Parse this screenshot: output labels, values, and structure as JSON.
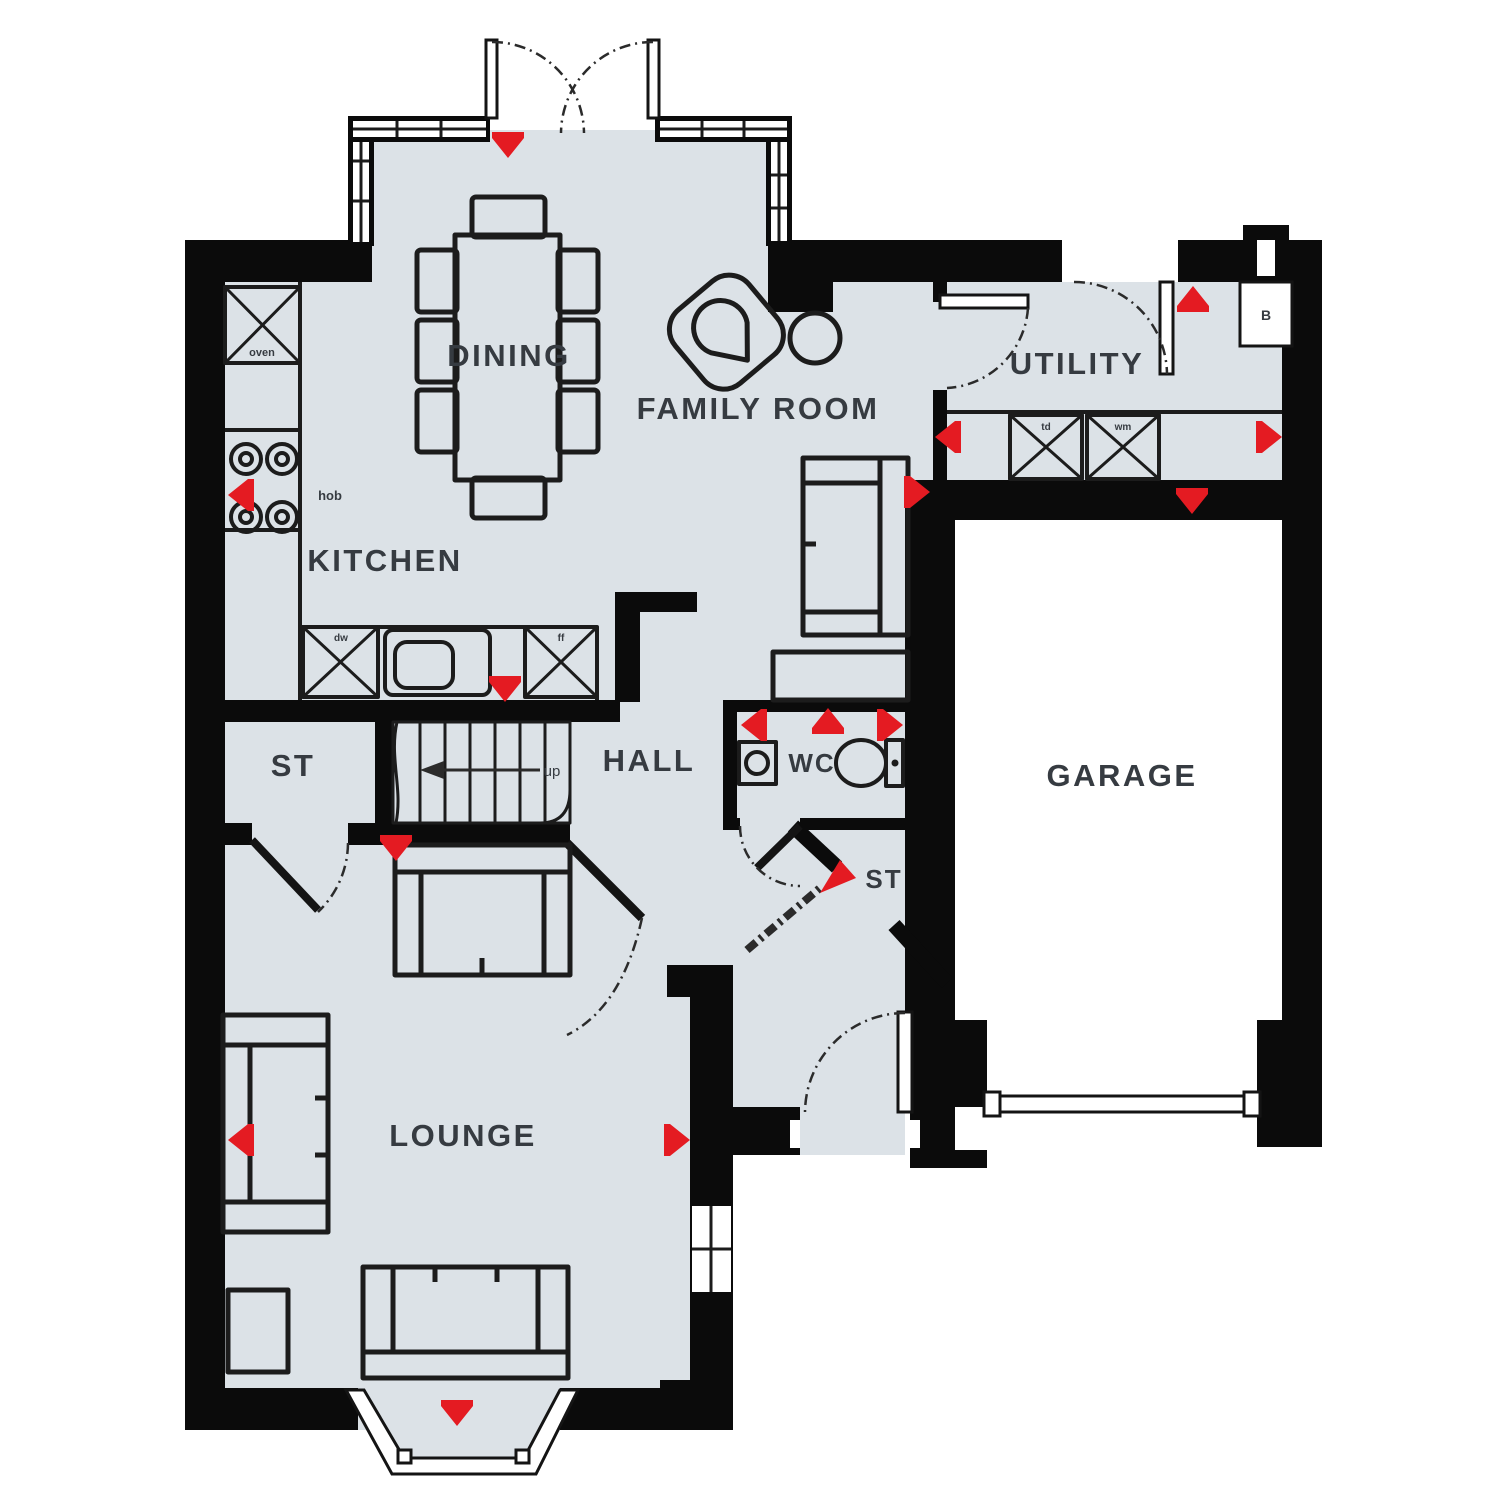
{
  "plan_title": "Ground Floor Plan",
  "colors": {
    "floor": "#dce2e7",
    "wall": "#0b0b0b",
    "marker_red": "#e41b22",
    "label": "#363b41",
    "fixture": "#1c1c1c",
    "outside": "#ffffff"
  },
  "rooms": [
    {
      "name": "dining",
      "label": "DINING"
    },
    {
      "name": "family-room",
      "label": "FAMILY ROOM"
    },
    {
      "name": "utility",
      "label": "UTILITY"
    },
    {
      "name": "kitchen",
      "label": "KITCHEN"
    },
    {
      "name": "store-1",
      "label": "ST"
    },
    {
      "name": "hall",
      "label": "HALL"
    },
    {
      "name": "wc",
      "label": "WC"
    },
    {
      "name": "store-2",
      "label": "ST"
    },
    {
      "name": "garage",
      "label": "GARAGE"
    },
    {
      "name": "lounge",
      "label": "LOUNGE"
    }
  ],
  "appliances": [
    {
      "name": "oven",
      "label": "oven"
    },
    {
      "name": "hob",
      "label": "hob"
    },
    {
      "name": "dishwasher",
      "label": "dw"
    },
    {
      "name": "fridge-freezer",
      "label": "ff"
    },
    {
      "name": "tumble-dryer",
      "label": "td"
    },
    {
      "name": "washing-machine",
      "label": "wm"
    },
    {
      "name": "boiler",
      "label": "B"
    }
  ],
  "stairs": {
    "direction_label": "up"
  }
}
